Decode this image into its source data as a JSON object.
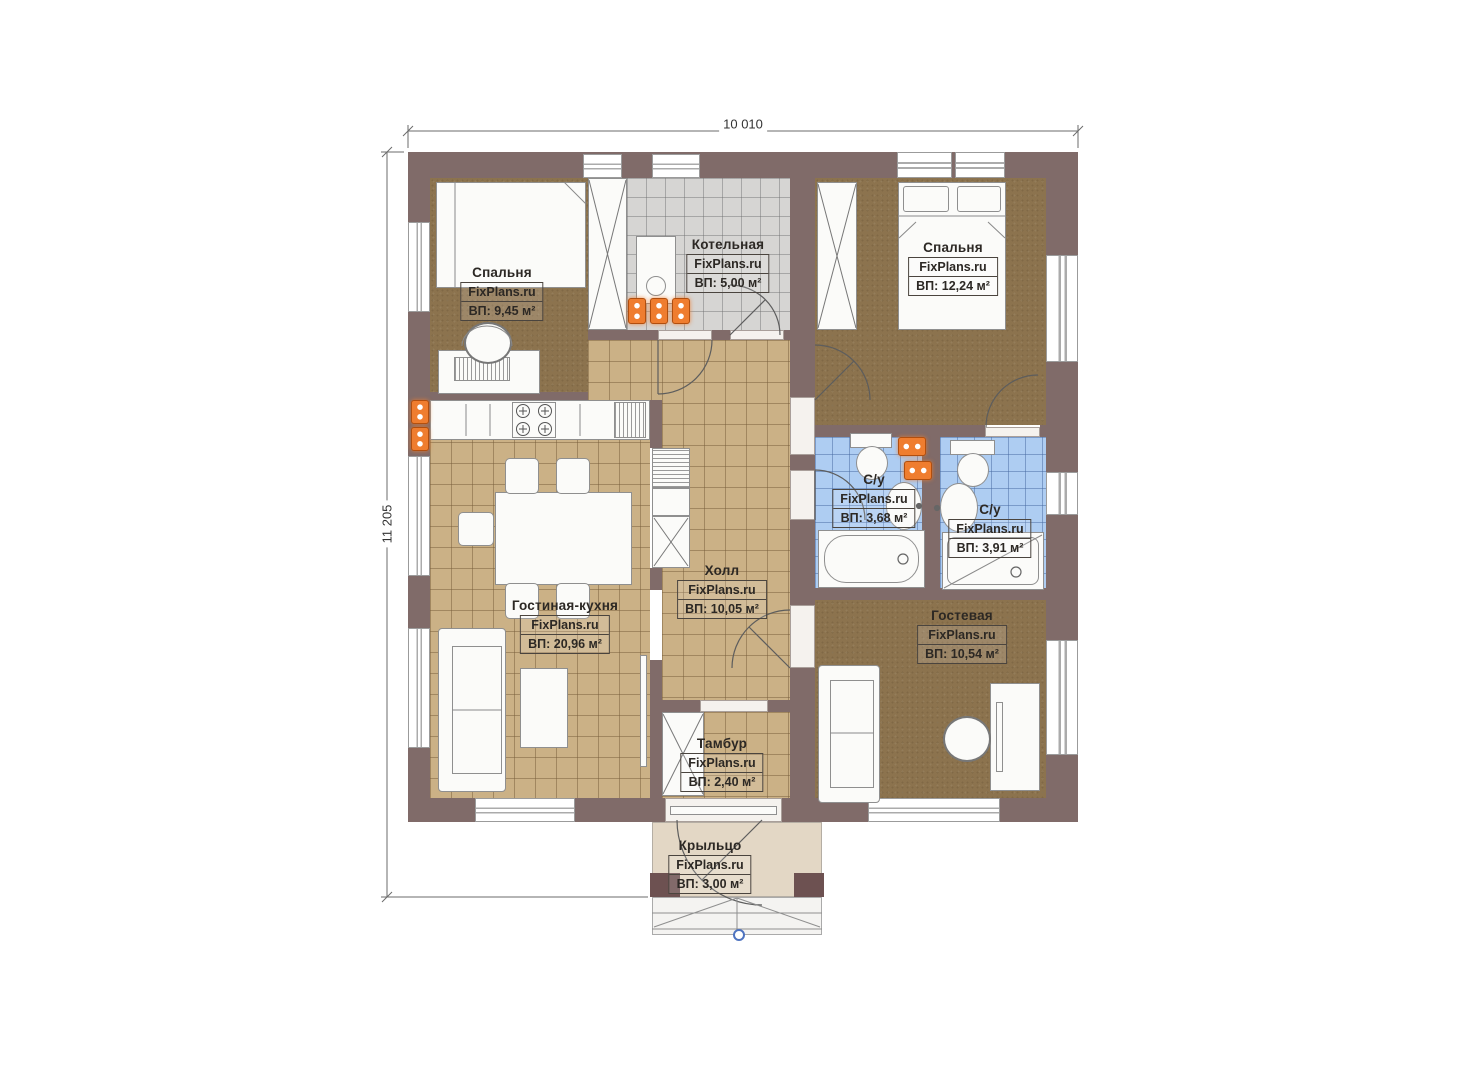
{
  "site_watermark": "FixPlans.ru",
  "dimensions": {
    "width": "10 010",
    "height": "11 205"
  },
  "rooms": [
    {
      "key": "bedroom-1",
      "name": "Спальня",
      "brand": "FixPlans.ru",
      "area": "ВП: 9,45 м²"
    },
    {
      "key": "boiler-room",
      "name": "Котельная",
      "brand": "FixPlans.ru",
      "area": "ВП: 5,00 м²"
    },
    {
      "key": "bedroom-2",
      "name": "Спальня",
      "brand": "FixPlans.ru",
      "area": "ВП: 12,24 м²"
    },
    {
      "key": "bathroom-1",
      "name": "С/у",
      "brand": "FixPlans.ru",
      "area": "ВП: 3,68 м²"
    },
    {
      "key": "bathroom-2",
      "name": "С/у",
      "brand": "FixPlans.ru",
      "area": "ВП: 3,91 м²"
    },
    {
      "key": "hall",
      "name": "Холл",
      "brand": "FixPlans.ru",
      "area": "ВП: 10,05 м²"
    },
    {
      "key": "living-kitchen",
      "name": "Гостиная-кухня",
      "brand": "FixPlans.ru",
      "area": "ВП: 20,96 м²"
    },
    {
      "key": "guest-room",
      "name": "Гостевая",
      "brand": "FixPlans.ru",
      "area": "ВП: 10,54 м²"
    },
    {
      "key": "vestibule",
      "name": "Тамбур",
      "brand": "FixPlans.ru",
      "area": "ВП: 2,40 м²"
    },
    {
      "key": "porch",
      "name": "Крыльцо",
      "brand": "FixPlans.ru",
      "area": "ВП: 3,00 м²"
    }
  ],
  "colors": {
    "wall": "#806b69",
    "carpet": "#8c734e",
    "tile": "#cbb186",
    "boiler_tile": "#d6d5d3",
    "bath_tile": "#aecdf2",
    "porch": "#e3d7c5",
    "radiator": "#ef7d2f",
    "step_marker": "#4f74c0"
  }
}
